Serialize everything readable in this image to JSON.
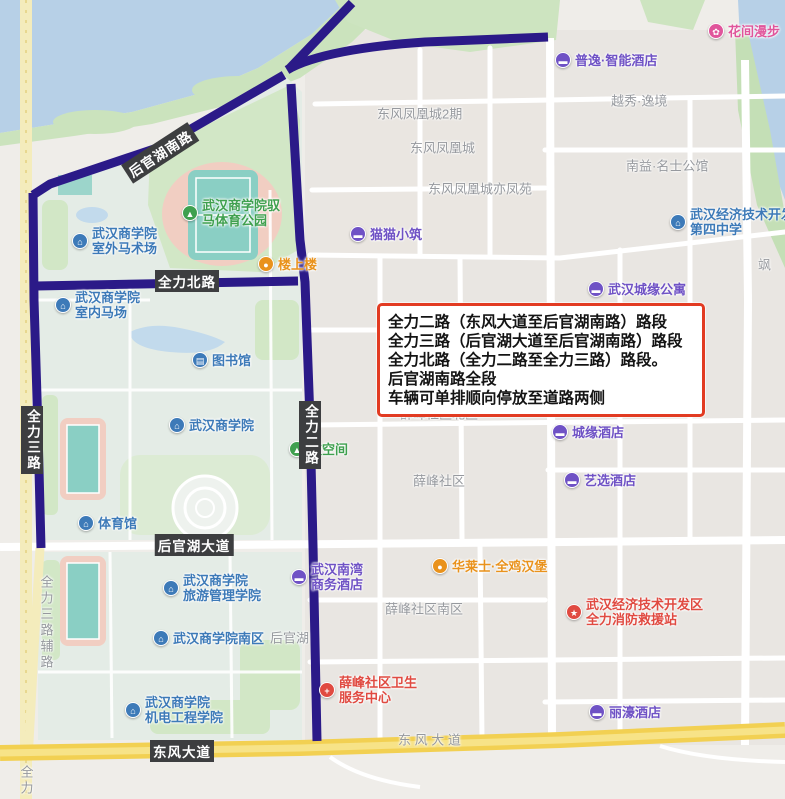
{
  "annotation": {
    "lines": [
      "全力二路（东风大道至后官湖南路）路段",
      "全力三路（后官湖大道至后官湖南路）路段",
      "全力北路（全力二路至全力三路）路段。",
      "后官湖南路全段",
      "车辆可单排顺向停放至道路两侧"
    ],
    "border_color": "#e23b22"
  },
  "colors": {
    "blue": "#3d7ab8",
    "green": "#3fa04f",
    "purple": "#6f52c5",
    "orange": "#e9921c",
    "red": "#e04a41",
    "pink": "#e0559b",
    "route_highlight": "#2b1a88",
    "road_label_bg": "#3d3e40",
    "water": "#b7d0e7",
    "main_road_yellow": "#f2d052"
  },
  "road_labels": [
    {
      "id": "houguanhu-south-rd",
      "text": "后官湖南路",
      "x": 160,
      "y": 153,
      "rotate": -33,
      "vertical": false
    },
    {
      "id": "quanli-north-rd",
      "text": "全力北路",
      "x": 187,
      "y": 281,
      "rotate": 0,
      "vertical": false
    },
    {
      "id": "quanli-3rd-rd",
      "text": "全力三路",
      "x": 32,
      "y": 440,
      "vertical": true
    },
    {
      "id": "quanli-2nd-rd",
      "text": "全力二路",
      "x": 310,
      "y": 435,
      "vertical": true
    },
    {
      "id": "houguanhu-ave",
      "text": "后官湖大道",
      "x": 194,
      "y": 545,
      "rotate": 0,
      "vertical": false
    },
    {
      "id": "dongfeng-ave",
      "text": "东风大道",
      "x": 182,
      "y": 751,
      "rotate": 0,
      "vertical": false
    }
  ],
  "minor_labels": [
    {
      "text": "东风凤凰城2期",
      "x": 377,
      "y": 113
    },
    {
      "text": "东风凤凰城",
      "x": 410,
      "y": 147
    },
    {
      "text": "东风凤凰城亦凤苑",
      "x": 428,
      "y": 188
    },
    {
      "text": "越秀·逸境",
      "x": 611,
      "y": 100
    },
    {
      "text": "南益·名士公馆",
      "x": 626,
      "y": 165
    },
    {
      "text": "薛峰社区北区",
      "x": 400,
      "y": 413
    },
    {
      "text": "薛峰社区",
      "x": 413,
      "y": 480
    },
    {
      "text": "薛峰社区南区",
      "x": 385,
      "y": 608
    },
    {
      "text": "后官湖",
      "x": 270,
      "y": 637
    },
    {
      "text": "东 风 大 道",
      "x": 398,
      "y": 739
    },
    {
      "text": "飒",
      "x": 758,
      "y": 264
    },
    {
      "text": "全力三路辅路",
      "x": 46,
      "y": 575,
      "vertical": true
    },
    {
      "text": "全力",
      "x": 26,
      "y": 765,
      "vertical": true
    }
  ],
  "pois": [
    {
      "color": "green",
      "icon": "park-icon",
      "x": 190,
      "y": 213,
      "lines": [
        "武汉商学院驭",
        "马体育公园"
      ]
    },
    {
      "color": "blue",
      "icon": "school-icon",
      "x": 80,
      "y": 241,
      "lines": [
        "武汉商学院",
        "室外马术场"
      ]
    },
    {
      "color": "blue",
      "icon": "school-icon",
      "x": 63,
      "y": 305,
      "lines": [
        "武汉商学院",
        "室内马场"
      ]
    },
    {
      "color": "blue",
      "icon": "library-icon",
      "x": 200,
      "y": 360,
      "lines": [
        "图书馆"
      ]
    },
    {
      "color": "blue",
      "icon": "school-icon",
      "x": 177,
      "y": 425,
      "lines": [
        "武汉商学院"
      ]
    },
    {
      "color": "blue",
      "icon": "gym-icon",
      "x": 86,
      "y": 523,
      "lines": [
        "体育馆"
      ]
    },
    {
      "color": "blue",
      "icon": "school-icon",
      "x": 171,
      "y": 588,
      "lines": [
        "武汉商学院",
        "旅游管理学院"
      ]
    },
    {
      "color": "blue",
      "icon": "school-icon",
      "x": 161,
      "y": 638,
      "lines": [
        "武汉商学院南区"
      ]
    },
    {
      "color": "blue",
      "icon": "school-icon",
      "x": 133,
      "y": 710,
      "lines": [
        "武汉商学院",
        "机电工程学院"
      ]
    },
    {
      "color": "blue",
      "icon": "school-icon",
      "x": 678,
      "y": 222,
      "lines": [
        "武汉经济技术开发区",
        "第四中学"
      ]
    },
    {
      "color": "green",
      "icon": "space-icon",
      "x": 297,
      "y": 449,
      "lines": [
        "枝空间"
      ]
    },
    {
      "color": "purple",
      "icon": "homestay-icon",
      "x": 358,
      "y": 234,
      "lines": [
        "猫猫小筑"
      ]
    },
    {
      "color": "purple",
      "icon": "hotel-icon",
      "x": 563,
      "y": 60,
      "lines": [
        "普逸·智能酒店"
      ]
    },
    {
      "color": "purple",
      "icon": "apartment-icon",
      "x": 596,
      "y": 289,
      "lines": [
        "武汉城缘公寓"
      ]
    },
    {
      "color": "purple",
      "icon": "hotel-icon",
      "x": 560,
      "y": 432,
      "lines": [
        "城缘酒店"
      ]
    },
    {
      "color": "purple",
      "icon": "hotel-icon",
      "x": 572,
      "y": 480,
      "lines": [
        "艺选酒店"
      ]
    },
    {
      "color": "purple",
      "icon": "hotel-icon",
      "x": 597,
      "y": 712,
      "lines": [
        "丽濠酒店"
      ]
    },
    {
      "color": "purple",
      "icon": "hotel-icon",
      "x": 299,
      "y": 577,
      "lines": [
        "武汉南湾",
        "商务酒店"
      ]
    },
    {
      "color": "orange",
      "icon": "restaurant-icon",
      "x": 266,
      "y": 264,
      "lines": [
        "楼上楼"
      ]
    },
    {
      "color": "orange",
      "icon": "restaurant-icon",
      "x": 440,
      "y": 566,
      "lines": [
        "华莱士·全鸡汉堡"
      ]
    },
    {
      "color": "red",
      "icon": "medical-icon",
      "x": 327,
      "y": 690,
      "lines": [
        "薛峰社区卫生",
        "服务中心"
      ]
    },
    {
      "color": "red",
      "icon": "fire-station-icon",
      "x": 574,
      "y": 612,
      "lines": [
        "武汉经济技术开发区",
        "全力消防救援站"
      ]
    },
    {
      "color": "pink",
      "icon": "flower-icon",
      "x": 716,
      "y": 31,
      "lines": [
        "花间漫步"
      ]
    }
  ]
}
